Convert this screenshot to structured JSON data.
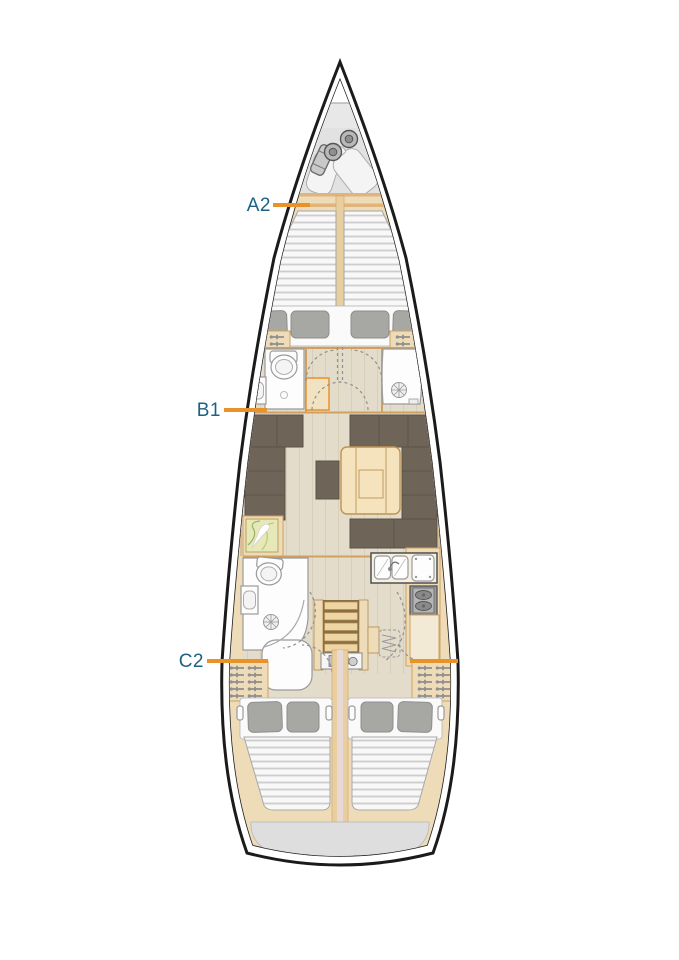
{
  "diagram": {
    "type": "sailing-yacht-deck-plan",
    "labels": [
      {
        "id": "a2",
        "text": "A2"
      },
      {
        "id": "b1",
        "text": "B1"
      },
      {
        "id": "c2",
        "text": "C2"
      }
    ],
    "colors": {
      "hull_outline": "#1b1b1b",
      "wood": "#eedcb9",
      "wood_trim": "#cfa061",
      "floor": "#e3dcca",
      "sofa": "#6e6458",
      "table_wood": "#f4e3bd",
      "mattress": "#f8f8f8",
      "mattress_rib": "#cdcdcd",
      "pillow": "#a7a7a4",
      "locker_gray": "#e8e8e8",
      "fixture_white": "#fdfdfd",
      "stern_gray": "#dedede",
      "map": "#e7e8b8",
      "label_text": "#1b6283",
      "label_line": "#e8922a"
    },
    "features": [
      "anchor-locker",
      "windlass",
      "fenders",
      "forward-v-berth",
      "forward-head-toilet",
      "forward-head-sink",
      "forward-shower",
      "saloon-sofa-port",
      "saloon-sofa-starboard",
      "saloon-table",
      "pouf",
      "chart-table",
      "galley-double-sink",
      "galley-stove",
      "aft-head-toilet",
      "aft-head-sink",
      "aft-shower",
      "companionway-steps",
      "engine-compartment",
      "hanging-lockers",
      "aft-cabin-port-berth",
      "aft-cabin-starboard-berth",
      "transom-locker",
      "hull-windows"
    ]
  }
}
